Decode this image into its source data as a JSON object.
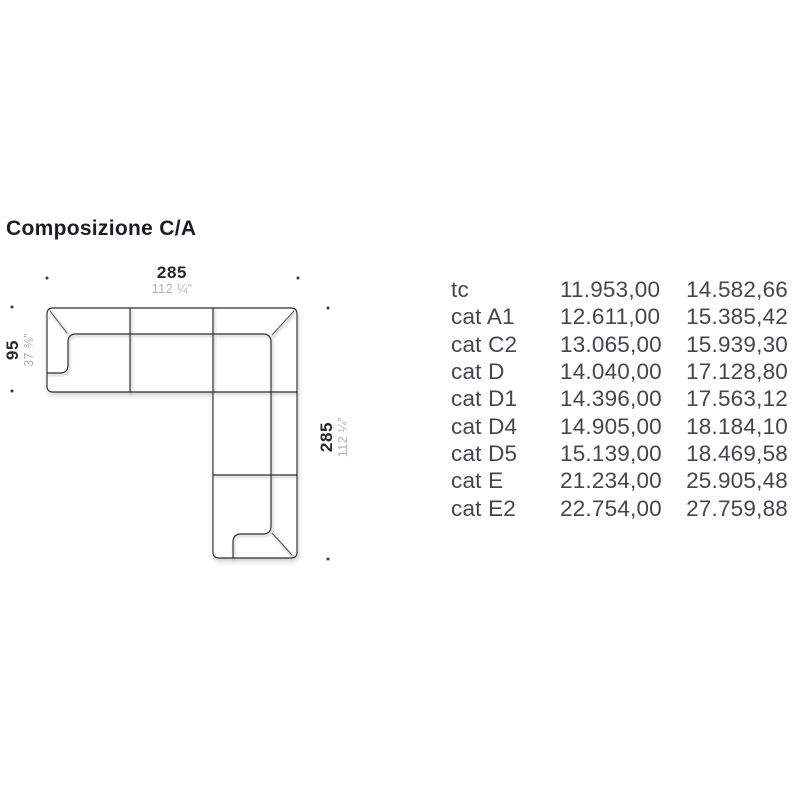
{
  "page": {
    "title": "Composizione C/A",
    "background": "#ffffff"
  },
  "colors": {
    "title": "#1c1c26",
    "table_text": "#45454e",
    "drawing_line": "#2d2d35",
    "dimension_primary": "#26262e",
    "dimension_secondary": "#b2b2b8"
  },
  "diagram": {
    "description": "sofa-sectional-corner-plan-view",
    "dimensions": {
      "top": {
        "cm": "285",
        "inches": "112 ¼”"
      },
      "left": {
        "cm": "95",
        "inches": "37 ⅜”"
      },
      "right": {
        "cm": "285",
        "inches": "112 ¼”"
      }
    }
  },
  "price_table": {
    "rows": [
      {
        "label": "tc",
        "price1": "11.953,00",
        "price2": "14.582,66"
      },
      {
        "label": "cat A1",
        "price1": "12.611,00",
        "price2": "15.385,42"
      },
      {
        "label": "cat C2",
        "price1": "13.065,00",
        "price2": "15.939,30"
      },
      {
        "label": "cat D",
        "price1": "14.040,00",
        "price2": "17.128,80"
      },
      {
        "label": "cat D1",
        "price1": "14.396,00",
        "price2": "17.563,12"
      },
      {
        "label": "cat D4",
        "price1": "14.905,00",
        "price2": "18.184,10"
      },
      {
        "label": "cat D5",
        "price1": "15.139,00",
        "price2": "18.469,58"
      },
      {
        "label": "cat E",
        "price1": "21.234,00",
        "price2": "25.905,48"
      },
      {
        "label": "cat E2",
        "price1": "22.754,00",
        "price2": "27.759,88"
      }
    ]
  }
}
